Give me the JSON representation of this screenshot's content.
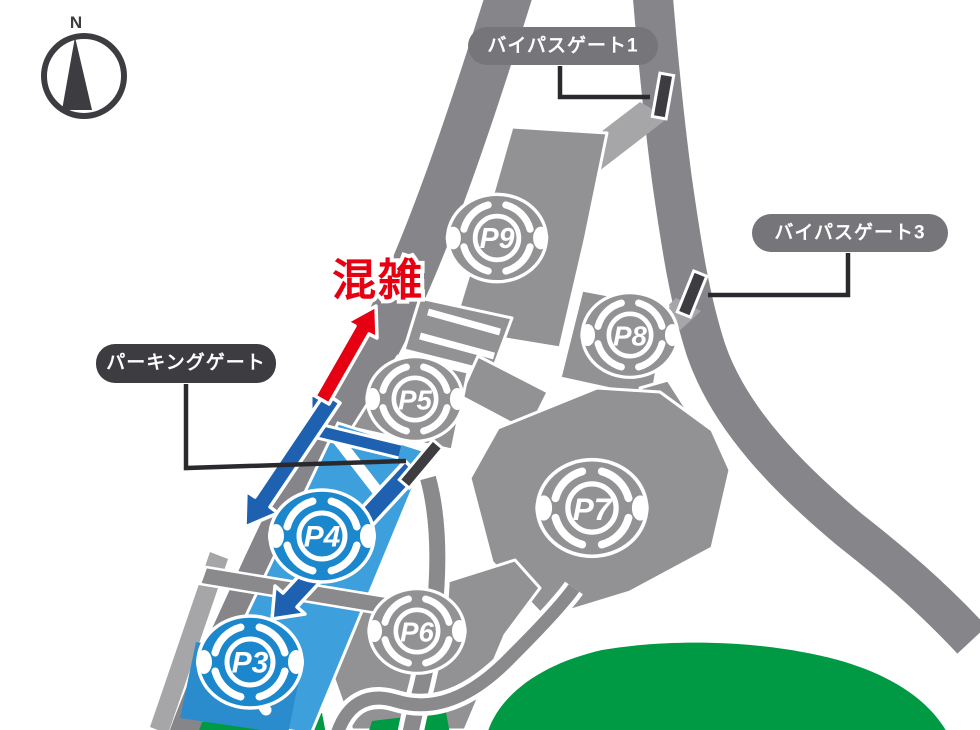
{
  "compass": {
    "label": "N"
  },
  "congestion": {
    "label": "混雑"
  },
  "gates": [
    {
      "id": "bypass-gate-1",
      "label": "バイパスゲート1"
    },
    {
      "id": "bypass-gate-3",
      "label": "バイパスゲート3"
    },
    {
      "id": "parking-gate",
      "label": "パーキングゲート"
    }
  ],
  "lots": [
    {
      "id": "p9",
      "label": "P9",
      "highlighted": false
    },
    {
      "id": "p8",
      "label": "P8",
      "highlighted": false
    },
    {
      "id": "p7",
      "label": "P7",
      "highlighted": false
    },
    {
      "id": "p6",
      "label": "P6",
      "highlighted": false
    },
    {
      "id": "p5",
      "label": "P5",
      "highlighted": false
    },
    {
      "id": "p4",
      "label": "P4",
      "highlighted": true
    },
    {
      "id": "p3",
      "label": "P3",
      "highlighted": true
    }
  ],
  "colors": {
    "road": "#85858a",
    "parking_lot": "#929295",
    "ramp": "#a6a6a9",
    "highlight_blue": "#3d9fdb",
    "highlight_block_blue": "#2b8ccd",
    "route_blue": "#1e61b0",
    "congestion_red": "#e60012",
    "green_area": "#009a44",
    "label_pill_gray": "#76767a",
    "label_pill_dark": "#3c3c41"
  }
}
